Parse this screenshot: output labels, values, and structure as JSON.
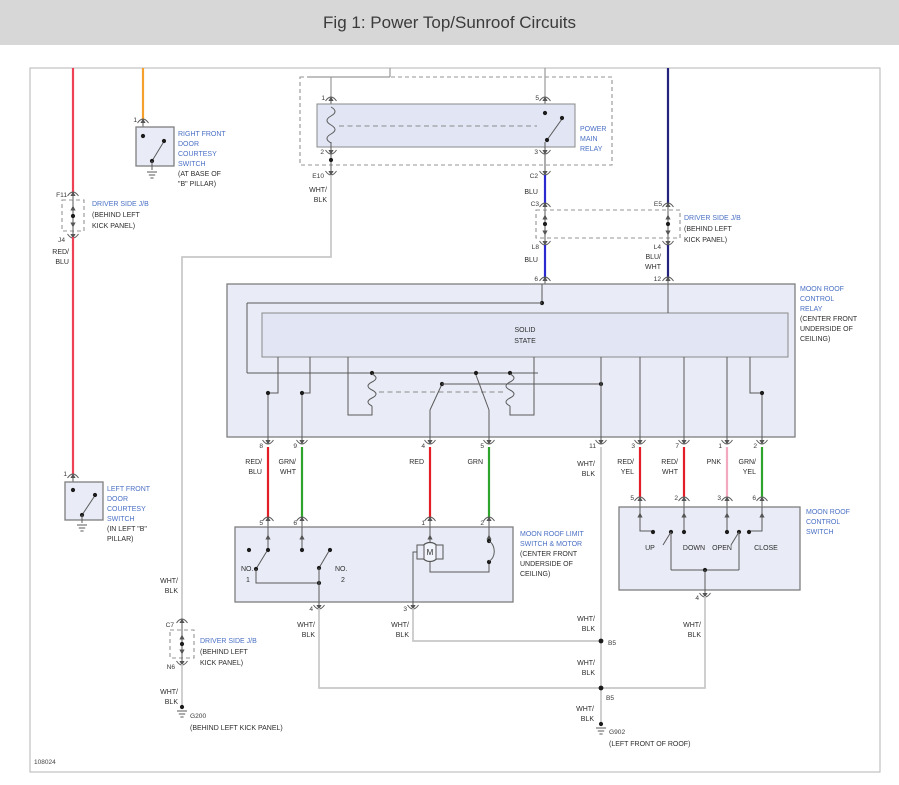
{
  "title": "Fig 1: Power Top/Sunroof Circuits",
  "drawing_number": "108024",
  "colors": {
    "titlebar_bg": "#d7d7d7",
    "label_blue": "#4a70c4",
    "red": "#e31e26",
    "red_feed": "#ef4156",
    "green": "#2fa42c",
    "pink": "#f2a9c0",
    "orange": "#f59f2c",
    "blue": "#2a2ad0",
    "navy": "#23237e",
    "gray_wire": "#c7c7c7"
  },
  "wire": {
    "wht": "WHT/",
    "blk": "BLK",
    "red": "RED",
    "red_s": "RED/",
    "blu": "BLU",
    "blu_s": "BLU/",
    "wht_w": "WHT",
    "grn": "GRN",
    "grn_s": "GRN/",
    "yel": "YEL",
    "pnk": "PNK"
  },
  "pin": {
    "n1": "1",
    "n2": "2",
    "n3": "3",
    "n4": "4",
    "n5": "5",
    "n6": "6",
    "n7": "7",
    "n8": "8",
    "n9": "9",
    "n11": "11",
    "n12": "12"
  },
  "conn": {
    "f11": "F11",
    "j4": "J4",
    "e10": "E10",
    "c2": "C2",
    "c3": "C3",
    "e5": "E5",
    "l8": "L8",
    "l4": "L4",
    "c7": "C7",
    "n6": "N6",
    "b5": "B5",
    "g200": "G200",
    "g902": "G902"
  },
  "labels": {
    "pmr": [
      "POWER",
      "MAIN",
      "RELAY"
    ],
    "rf": [
      "RIGHT FRONT",
      "DOOR",
      "COURTESY",
      "SWITCH"
    ],
    "rf_loc": [
      "(AT BASE OF",
      "\"B\" PILLAR)"
    ],
    "lf": [
      "LEFT FRONT",
      "DOOR",
      "COURTESY",
      "SWITCH"
    ],
    "lf_loc": [
      "(IN LEFT \"B\"",
      "PILLAR)"
    ],
    "jb": "DRIVER SIDE J/B",
    "jb_loc": [
      "(BEHIND LEFT",
      "KICK PANEL)"
    ],
    "mrr": [
      "MOON ROOF",
      "CONTROL",
      "RELAY"
    ],
    "ceiling": [
      "(CENTER FRONT",
      "UNDERSIDE OF",
      "CEILING)"
    ],
    "ss": [
      "SOLID",
      "STATE"
    ],
    "limit": [
      "MOON ROOF LIMIT",
      "SWITCH & MOTOR"
    ],
    "mrs": [
      "MOON ROOF",
      "CONTROL",
      "SWITCH"
    ],
    "pos": [
      "UP",
      "DOWN",
      "OPEN",
      "CLOSE"
    ],
    "no": "NO.",
    "m": "M",
    "g200_loc": "(BEHIND LEFT KICK PANEL)",
    "g902_loc": "(LEFT FRONT OF ROOF)"
  }
}
